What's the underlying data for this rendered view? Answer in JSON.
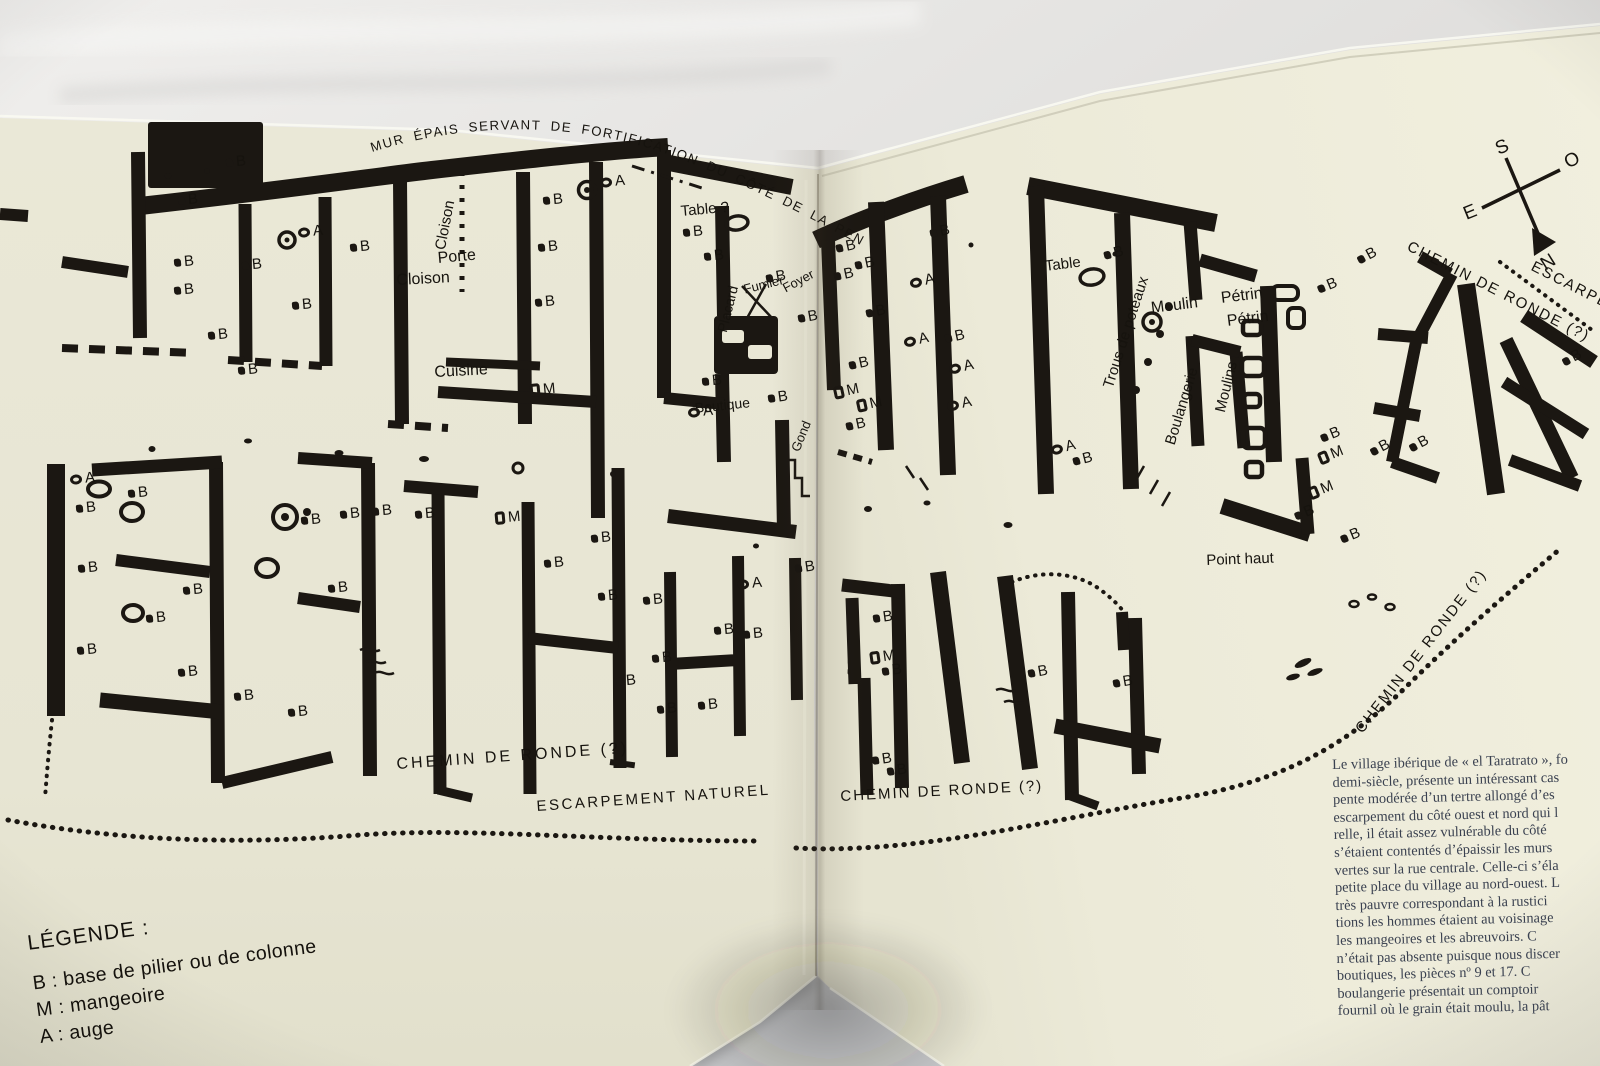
{
  "plan": {
    "title_arc": "MUR ÉPAIS SERVANT DE FORTIFICATION DU CÔTÉ DE LA PENTE DOUCE",
    "labels": [
      {
        "t": "Table ?",
        "x": 680,
        "y": 203,
        "r": -5,
        "s": 15
      },
      {
        "t": "Cloison",
        "x": 432,
        "y": 248,
        "r": -79,
        "s": 15
      },
      {
        "t": "Porte",
        "x": 437,
        "y": 250,
        "r": -5,
        "s": 16
      },
      {
        "t": "Cloison",
        "x": 396,
        "y": 272,
        "r": -3,
        "s": 16
      },
      {
        "t": "Cuisine",
        "x": 434,
        "y": 364,
        "r": -3,
        "s": 16
      },
      {
        "t": "Placard",
        "x": 714,
        "y": 330,
        "r": -76,
        "s": 14
      },
      {
        "t": "Fumier",
        "x": 742,
        "y": 282,
        "r": -14,
        "s": 13
      },
      {
        "t": "Foyer",
        "x": 780,
        "y": 282,
        "r": -28,
        "s": 13
      },
      {
        "t": "Boutique",
        "x": 694,
        "y": 400,
        "r": -6,
        "s": 14
      },
      {
        "t": "Gond",
        "x": 788,
        "y": 448,
        "r": -68,
        "s": 13
      },
      {
        "t": "Table",
        "x": 1044,
        "y": 258,
        "r": -7,
        "s": 15
      },
      {
        "t": "Trous de poteaux",
        "x": 1100,
        "y": 385,
        "r": -72,
        "s": 15
      },
      {
        "t": "Moulin",
        "x": 1150,
        "y": 300,
        "r": -7,
        "s": 16
      },
      {
        "t": "Pétrin",
        "x": 1220,
        "y": 290,
        "r": -7,
        "s": 16
      },
      {
        "t": "Pétrin",
        "x": 1226,
        "y": 313,
        "r": -7,
        "s": 16
      },
      {
        "t": "Moulins",
        "x": 1212,
        "y": 410,
        "r": -76,
        "s": 15
      },
      {
        "t": "Boulangerie",
        "x": 1162,
        "y": 442,
        "r": -73,
        "s": 15
      },
      {
        "t": "Point haut",
        "x": 1206,
        "y": 552,
        "r": -2,
        "s": 15
      },
      {
        "t": "CHEMIN DE RONDE (?)",
        "x": 396,
        "y": 756,
        "r": -4,
        "s": 16,
        "ls": 3
      },
      {
        "t": "ESCARPEMENT NATUREL",
        "x": 536,
        "y": 798,
        "r": -4,
        "s": 15,
        "ls": 2.5
      },
      {
        "t": "CHEMIN DE RONDE (?)",
        "x": 840,
        "y": 788,
        "r": -3,
        "s": 15,
        "ls": 2
      },
      {
        "t": "CHEMIN DE RONDE (?)",
        "x": 1352,
        "y": 726,
        "r": -52,
        "s": 15,
        "ls": 2
      },
      {
        "t": "CHEMIN DE RONDE (?)",
        "x": 1412,
        "y": 238,
        "r": 27,
        "s": 15,
        "ls": 2
      },
      {
        "t": "ESCARPEM",
        "x": 1536,
        "y": 258,
        "r": 27,
        "s": 15,
        "ls": 2
      }
    ],
    "markers": [
      {
        "t": "B",
        "x": 226,
        "y": 160
      },
      {
        "t": "B",
        "x": 178,
        "y": 198
      },
      {
        "t": "A",
        "x": 298,
        "y": 230
      },
      {
        "t": "B",
        "x": 350,
        "y": 245
      },
      {
        "t": "B",
        "x": 174,
        "y": 260
      },
      {
        "t": "B",
        "x": 242,
        "y": 263
      },
      {
        "t": "B",
        "x": 292,
        "y": 303
      },
      {
        "t": "B",
        "x": 174,
        "y": 288
      },
      {
        "t": "B",
        "x": 208,
        "y": 333
      },
      {
        "t": "B",
        "x": 238,
        "y": 368
      },
      {
        "t": "B",
        "x": 543,
        "y": 198
      },
      {
        "t": "B",
        "x": 538,
        "y": 245
      },
      {
        "t": "B",
        "x": 535,
        "y": 300
      },
      {
        "t": "A",
        "x": 600,
        "y": 180
      },
      {
        "t": "M",
        "x": 530,
        "y": 388
      },
      {
        "t": "B",
        "x": 683,
        "y": 230
      },
      {
        "t": "B",
        "x": 704,
        "y": 254
      },
      {
        "t": "B",
        "x": 766,
        "y": 276,
        "r": -10
      },
      {
        "t": "B",
        "x": 798,
        "y": 316,
        "r": -10
      },
      {
        "t": "B",
        "x": 702,
        "y": 379
      },
      {
        "t": "B",
        "x": 768,
        "y": 396,
        "r": -8
      },
      {
        "t": "A",
        "x": 688,
        "y": 410
      },
      {
        "t": "B",
        "x": 836,
        "y": 246,
        "r": -12
      },
      {
        "t": "B",
        "x": 855,
        "y": 263,
        "r": -12
      },
      {
        "t": "B",
        "x": 834,
        "y": 274,
        "r": -12
      },
      {
        "t": "B",
        "x": 866,
        "y": 311,
        "r": -12
      },
      {
        "t": "A",
        "x": 910,
        "y": 281,
        "r": -12
      },
      {
        "t": "A",
        "x": 904,
        "y": 340,
        "r": -12
      },
      {
        "t": "B",
        "x": 849,
        "y": 363,
        "r": -12
      },
      {
        "t": "M",
        "x": 834,
        "y": 391,
        "r": -12
      },
      {
        "t": "M",
        "x": 857,
        "y": 404,
        "r": -12
      },
      {
        "t": "B",
        "x": 846,
        "y": 424,
        "r": -12
      },
      {
        "t": "B",
        "x": 930,
        "y": 231,
        "r": -12
      },
      {
        "t": "B",
        "x": 945,
        "y": 336,
        "r": -12
      },
      {
        "t": "A",
        "x": 949,
        "y": 367,
        "r": -12
      },
      {
        "t": "A",
        "x": 947,
        "y": 404,
        "r": -12
      },
      {
        "t": "A",
        "x": 1051,
        "y": 448,
        "r": -14
      },
      {
        "t": "B",
        "x": 1073,
        "y": 459,
        "r": -14
      },
      {
        "t": "B",
        "x": 1104,
        "y": 253,
        "r": -14
      },
      {
        "t": "B",
        "x": 1318,
        "y": 287,
        "r": -22
      },
      {
        "t": "B",
        "x": 1321,
        "y": 436,
        "r": -22
      },
      {
        "t": "M",
        "x": 1319,
        "y": 457,
        "r": -22
      },
      {
        "t": "M",
        "x": 1309,
        "y": 492,
        "r": -22
      },
      {
        "t": "B",
        "x": 1295,
        "y": 514,
        "r": -22
      },
      {
        "t": "B",
        "x": 1341,
        "y": 537,
        "r": -22
      },
      {
        "t": "B",
        "x": 1358,
        "y": 258,
        "r": -28
      },
      {
        "t": "B",
        "x": 1410,
        "y": 446,
        "r": -28
      },
      {
        "t": "B",
        "x": 1371,
        "y": 450,
        "r": -28
      },
      {
        "t": "B",
        "x": 1563,
        "y": 360,
        "r": -28
      },
      {
        "t": "A",
        "x": 70,
        "y": 477
      },
      {
        "t": "B",
        "x": 128,
        "y": 491
      },
      {
        "t": "B",
        "x": 76,
        "y": 506
      },
      {
        "t": "B",
        "x": 78,
        "y": 566
      },
      {
        "t": "B",
        "x": 183,
        "y": 588
      },
      {
        "t": "B",
        "x": 146,
        "y": 616
      },
      {
        "t": "B",
        "x": 77,
        "y": 648
      },
      {
        "t": "B",
        "x": 178,
        "y": 670
      },
      {
        "t": "B",
        "x": 234,
        "y": 694
      },
      {
        "t": "B",
        "x": 288,
        "y": 710
      },
      {
        "t": "B",
        "x": 301,
        "y": 518
      },
      {
        "t": "B",
        "x": 340,
        "y": 512
      },
      {
        "t": "B",
        "x": 372,
        "y": 509
      },
      {
        "t": "B",
        "x": 328,
        "y": 586
      },
      {
        "t": "B",
        "x": 415,
        "y": 512
      },
      {
        "t": "M",
        "x": 495,
        "y": 516
      },
      {
        "t": "B",
        "x": 591,
        "y": 536
      },
      {
        "t": "B",
        "x": 544,
        "y": 561
      },
      {
        "t": "B",
        "x": 598,
        "y": 594
      },
      {
        "t": "B",
        "x": 643,
        "y": 598
      },
      {
        "t": "A",
        "x": 737,
        "y": 582
      },
      {
        "t": "B",
        "x": 714,
        "y": 628
      },
      {
        "t": "B",
        "x": 743,
        "y": 632
      },
      {
        "t": "B",
        "x": 652,
        "y": 656
      },
      {
        "t": "B",
        "x": 616,
        "y": 679
      },
      {
        "t": "B",
        "x": 657,
        "y": 707
      },
      {
        "t": "B",
        "x": 698,
        "y": 703
      },
      {
        "t": "B",
        "x": 795,
        "y": 566,
        "r": -8
      },
      {
        "t": "B",
        "x": 873,
        "y": 616,
        "r": -8
      },
      {
        "t": "M",
        "x": 870,
        "y": 656,
        "r": -8
      },
      {
        "t": "B",
        "x": 882,
        "y": 669,
        "r": -8
      },
      {
        "t": "B",
        "x": 872,
        "y": 758,
        "r": -8
      },
      {
        "t": "B",
        "x": 887,
        "y": 769,
        "r": -8
      },
      {
        "t": "B",
        "x": 1028,
        "y": 671,
        "r": -10
      },
      {
        "t": "B",
        "x": 1113,
        "y": 681,
        "r": -10
      }
    ]
  },
  "compass": {
    "s": "S",
    "o": "O",
    "e": "E",
    "n": "N"
  },
  "legend": {
    "title": "LÉGENDE :",
    "items": [
      "B : base de pilier ou de colonne",
      "M : mangeoire",
      "A : auge"
    ]
  },
  "article": {
    "lines": [
      "Le village ibérique de « el Taratrato », fo",
      "demi-siècle, présente un intéressant cas",
      "pente modérée d’un tertre allongé d’es",
      "escarpement du côté ouest et nord qui l",
      "relle, il était assez vulnérable du côté",
      "s’étaient contentés d’épaissir les murs",
      "vertes sur la rue centrale. Celle-ci s’éla",
      "petite place du village au nord-ouest. L",
      "très pauvre correspondant à la rustici",
      "tions les hommes étaient au voisinage",
      "les mangeoires et les abreuvoirs. C",
      "n’était pas absente puisque nous discer",
      "boutiques, les pièces nº 9 et 17. C",
      "boulangerie présentait un comptoir",
      "fournil où le grain était moulu, la pât"
    ]
  }
}
